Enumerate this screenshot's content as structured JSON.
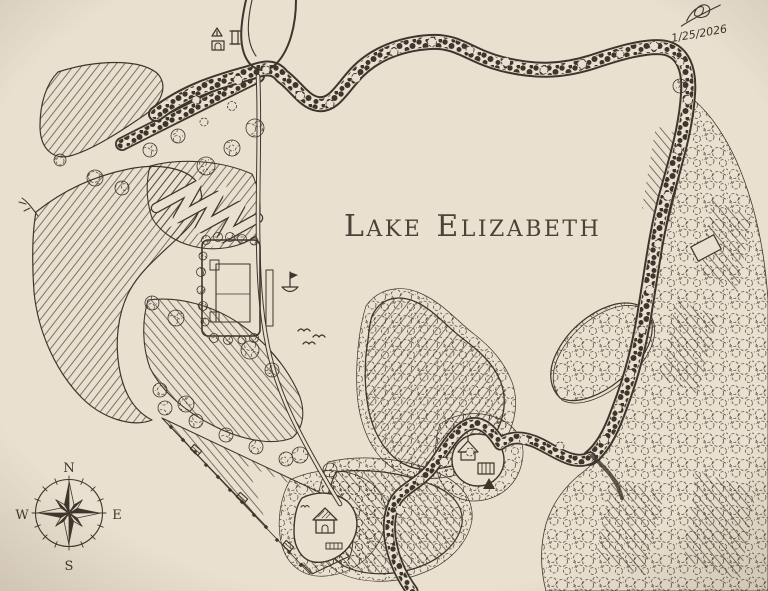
{
  "map": {
    "title": {
      "full": "Lake Elizabeth",
      "word1_initial": "L",
      "word1_rest": "AKE",
      "word2_initial": "E",
      "word2_rest": "LIZABETH"
    },
    "annotation": {
      "date": "1/25/2026"
    },
    "compass": {
      "north": "N",
      "east": "E",
      "south": "S",
      "west": "W"
    },
    "palette": {
      "paper": "#e9e0d0",
      "paper_edge": "#d7ccb8",
      "ink": "#3d362c",
      "ink_soft": "#6a604f"
    },
    "icons": [
      "compass-rose-icon",
      "sailboat-icon",
      "flying-birds-icon",
      "tent-icon",
      "cabin-icon",
      "pavilion-icon",
      "monument-icon",
      "bench-icon",
      "signature-flourish-icon"
    ],
    "features": {
      "waterbody": "lake",
      "landmarks": [
        "island",
        "peninsula",
        "tree-lined-shore-road",
        "east-forest",
        "west-hills",
        "switchback-trail",
        "building-complex",
        "pavilion-clearing",
        "cabin-clearing",
        "shore-fence",
        "entrance-loop"
      ]
    }
  }
}
